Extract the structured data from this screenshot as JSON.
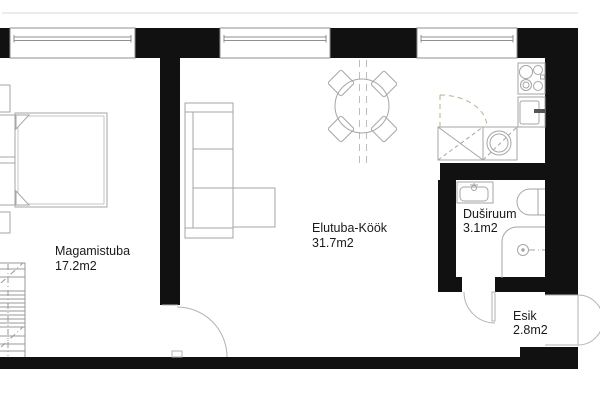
{
  "floor_plan": {
    "rooms": [
      {
        "name": "Magamistuba",
        "area": "17.2m2"
      },
      {
        "name": "Elutuba-Köök",
        "area": "31.7m2"
      },
      {
        "name": "Duširuum",
        "area": "3.1m2"
      },
      {
        "name": "Esik",
        "area": "2.8m2"
      }
    ],
    "colors": {
      "wall": "#111111",
      "furniture_line": "#a6a6a6",
      "door_window_line": "#b3b3b3",
      "cabinet_dash": "#b9b08b",
      "label_text": "#1a1a1a",
      "background": "#ffffff"
    }
  }
}
